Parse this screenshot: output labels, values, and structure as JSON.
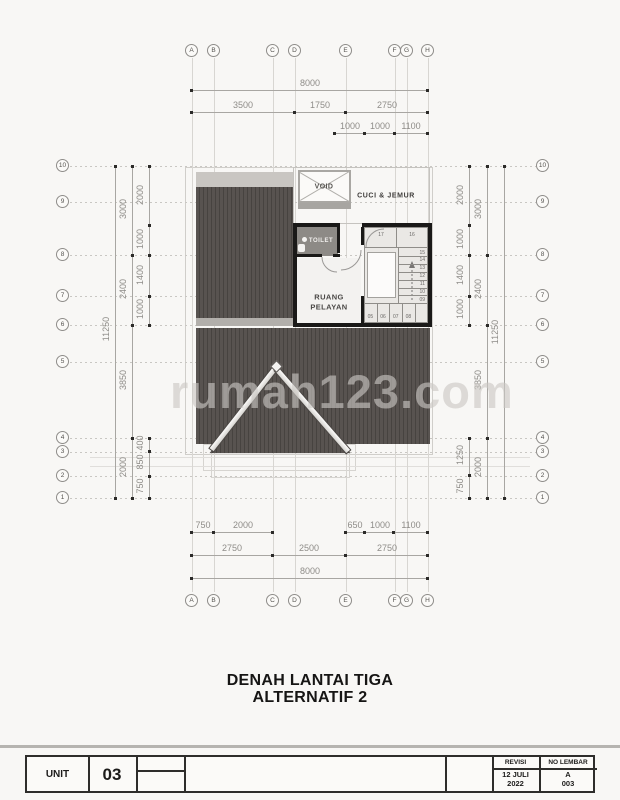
{
  "watermark": "rumah123.com",
  "drawing_title": {
    "line1": "DENAH LANTAI TIGA",
    "line2": "ALTERNATIF 2"
  },
  "rooms": {
    "void": "VOID",
    "cuci_jemur": "CUCI & JEMUR",
    "toilet": "TOILET",
    "ruang_pelayan_line1": "RUANG",
    "ruang_pelayan_line2": "PELAYAN"
  },
  "stair": {
    "landing": [
      "17",
      "16"
    ],
    "right_flight": [
      "15",
      "14",
      "13",
      "12",
      "11",
      "10",
      "09"
    ],
    "bottom_flight": [
      "05",
      "06",
      "07",
      "08"
    ]
  },
  "grid": {
    "cols": [
      {
        "label": "A",
        "x": 192
      },
      {
        "label": "B",
        "x": 214
      },
      {
        "label": "C",
        "x": 273
      },
      {
        "label": "D",
        "x": 295
      },
      {
        "label": "E",
        "x": 346
      },
      {
        "label": "F",
        "x": 395
      },
      {
        "label": "G",
        "x": 407
      },
      {
        "label": "H",
        "x": 428
      }
    ],
    "rows": [
      {
        "label": "10",
        "y": 166
      },
      {
        "label": "9",
        "y": 202
      },
      {
        "label": "8",
        "y": 255
      },
      {
        "label": "7",
        "y": 296
      },
      {
        "label": "6",
        "y": 325
      },
      {
        "label": "5",
        "y": 362
      },
      {
        "label": "4",
        "y": 438
      },
      {
        "label": "3",
        "y": 452
      },
      {
        "label": "2",
        "y": 476
      },
      {
        "label": "1",
        "y": 498
      }
    ]
  },
  "dims_h": [
    {
      "y": 90,
      "x1": 192,
      "x2": 428,
      "dots": [
        192,
        428
      ],
      "labels": [
        {
          "t": "8000",
          "x": 310
        }
      ]
    },
    {
      "y": 112,
      "x1": 192,
      "x2": 428,
      "dots": [
        192,
        295,
        346,
        428
      ],
      "labels": [
        {
          "t": "3500",
          "x": 243
        },
        {
          "t": "1750",
          "x": 320
        },
        {
          "t": "2750",
          "x": 387
        }
      ]
    },
    {
      "y": 133,
      "x1": 335,
      "x2": 428,
      "dots": [
        335,
        365,
        395,
        428
      ],
      "labels": [
        {
          "t": "1000",
          "x": 350
        },
        {
          "t": "1000",
          "x": 380
        },
        {
          "t": "1100",
          "x": 411
        }
      ]
    },
    {
      "y": 532,
      "x1": 192,
      "x2": 273,
      "dots": [
        192,
        214,
        273
      ],
      "labels": [
        {
          "t": "750",
          "x": 203
        },
        {
          "t": "2000",
          "x": 243
        }
      ]
    },
    {
      "y": 532,
      "x1": 346,
      "x2": 428,
      "dots": [
        346,
        365,
        394,
        428
      ],
      "labels": [
        {
          "t": "650",
          "x": 355
        },
        {
          "t": "1000",
          "x": 380
        },
        {
          "t": "1100",
          "x": 411
        }
      ]
    },
    {
      "y": 555,
      "x1": 192,
      "x2": 428,
      "dots": [
        192,
        273,
        346,
        428
      ],
      "labels": [
        {
          "t": "2750",
          "x": 232
        },
        {
          "t": "2500",
          "x": 309
        },
        {
          "t": "2750",
          "x": 387
        }
      ]
    },
    {
      "y": 578,
      "x1": 192,
      "x2": 428,
      "dots": [
        192,
        428
      ],
      "labels": [
        {
          "t": "8000",
          "x": 310
        }
      ]
    }
  ],
  "dims_v": [
    {
      "x": 115,
      "y1": 166,
      "y2": 498,
      "dots": [
        166,
        498
      ],
      "labels": [
        {
          "t": "11250",
          "y": 330
        }
      ]
    },
    {
      "x": 132,
      "y1": 166,
      "y2": 498,
      "dots": [
        166,
        255,
        325,
        438,
        498
      ],
      "labels": [
        {
          "t": "3000",
          "y": 210
        },
        {
          "t": "2400",
          "y": 290
        },
        {
          "t": "3850",
          "y": 381
        },
        {
          "t": "2000",
          "y": 468
        }
      ]
    },
    {
      "x": 149,
      "y1": 166,
      "y2": 325,
      "dots": [
        166,
        225,
        255,
        296,
        325
      ],
      "labels": [
        {
          "t": "2000",
          "y": 196
        },
        {
          "t": "1000",
          "y": 240
        },
        {
          "t": "1400",
          "y": 276
        },
        {
          "t": "1000",
          "y": 310
        }
      ]
    },
    {
      "x": 149,
      "y1": 438,
      "y2": 498,
      "dots": [
        438,
        451,
        476,
        498
      ],
      "labels": [
        {
          "t": "400",
          "y": 444
        },
        {
          "t": "850",
          "y": 463
        },
        {
          "t": "750",
          "y": 487
        }
      ]
    },
    {
      "x": 469,
      "y1": 166,
      "y2": 325,
      "dots": [
        166,
        225,
        255,
        296,
        325
      ],
      "labels": [
        {
          "t": "2000",
          "y": 196
        },
        {
          "t": "1000",
          "y": 240
        },
        {
          "t": "1400",
          "y": 276
        },
        {
          "t": "1000",
          "y": 310
        }
      ]
    },
    {
      "x": 469,
      "y1": 438,
      "y2": 498,
      "dots": [
        438,
        475,
        498
      ],
      "labels": [
        {
          "t": "1250",
          "y": 456
        },
        {
          "t": "750",
          "y": 487
        }
      ]
    },
    {
      "x": 487,
      "y1": 166,
      "y2": 498,
      "dots": [
        166,
        255,
        325,
        438,
        498
      ],
      "labels": [
        {
          "t": "3000",
          "y": 210
        },
        {
          "t": "2400",
          "y": 290
        },
        {
          "t": "3850",
          "y": 381
        },
        {
          "t": "2000",
          "y": 468
        }
      ]
    },
    {
      "x": 504,
      "y1": 166,
      "y2": 498,
      "dots": [
        166,
        498
      ],
      "labels": [
        {
          "t": "11250",
          "y": 333
        }
      ]
    }
  ],
  "titleblock": {
    "unit_label": "UNIT",
    "unit_number": "03",
    "revisi_label": "REVISI",
    "revisi_date_line1": "12 JULI",
    "revisi_date_line2": "2022",
    "no_lembar_label": "NO LEMBAR",
    "no_lembar_line1": "A",
    "no_lembar_line2": "003"
  },
  "colors": {
    "roof_dark": "#585350",
    "roof_stripe": "#474340",
    "roof_ridge_light": "#c9c6c2",
    "wall_black": "#1a1918",
    "toilet_floor": "#8d8a86",
    "dim_text": "#8e8c88",
    "watermark_gray": "#cbc8c4"
  }
}
